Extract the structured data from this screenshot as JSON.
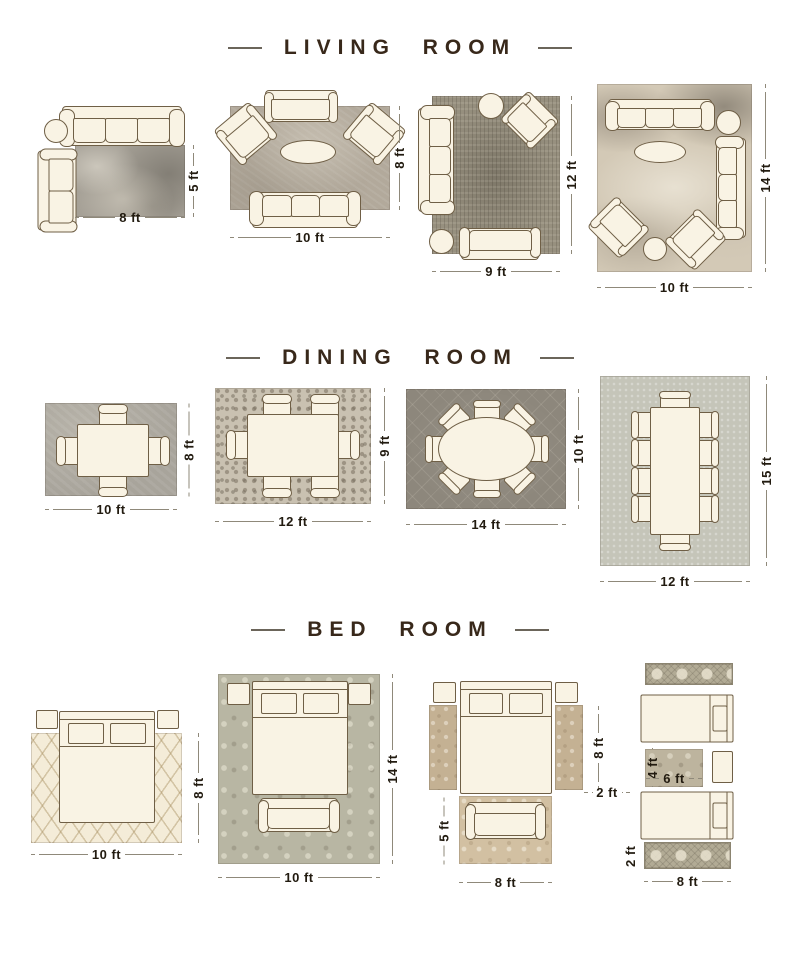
{
  "colors": {
    "background": "#ffffff",
    "title_text": "#38281a",
    "dimension_text": "#221b10",
    "dimension_line": "#8f897a",
    "furniture_fill": "#f9f3e4",
    "furniture_outline": "#6f5f46"
  },
  "sections": [
    {
      "title": "LIVING ROOM",
      "figures": [
        {
          "name": "living-8x5",
          "width_label": "8 ft",
          "height_label": "5 ft",
          "furniture": [
            "3-seat sofa",
            "round side table",
            "loveseat"
          ]
        },
        {
          "name": "living-10x8",
          "width_label": "10 ft",
          "height_label": "8 ft",
          "furniture": [
            "loveseat",
            "2 armchairs",
            "oval coffee table",
            "3-seat sofa"
          ]
        },
        {
          "name": "living-9x12",
          "width_label": "9 ft",
          "height_label": "12 ft",
          "furniture": [
            "3-seat sofa",
            "round side table",
            "armchair",
            "round side table",
            "loveseat"
          ]
        },
        {
          "name": "living-10x14",
          "width_label": "10 ft",
          "height_label": "14 ft",
          "furniture": [
            "3-seat sofa",
            "round side table",
            "oval coffee table",
            "3-seat sofa",
            "2 armchairs",
            "round side table"
          ]
        }
      ]
    },
    {
      "title": "DINING ROOM",
      "figures": [
        {
          "name": "dining-10x8",
          "width_label": "10 ft",
          "height_label": "8 ft",
          "furniture": [
            "dining table",
            "4 chairs"
          ]
        },
        {
          "name": "dining-12x9",
          "width_label": "12 ft",
          "height_label": "9 ft",
          "furniture": [
            "dining table",
            "6 chairs"
          ]
        },
        {
          "name": "dining-14x10",
          "width_label": "14 ft",
          "height_label": "10 ft",
          "furniture": [
            "oval dining table",
            "8 chairs"
          ]
        },
        {
          "name": "dining-12x15",
          "width_label": "12 ft",
          "height_label": "15 ft",
          "furniture": [
            "dining table",
            "10 chairs"
          ]
        }
      ]
    },
    {
      "title": "BED ROOM",
      "figures": [
        {
          "name": "bed-10x8",
          "width_label": "10 ft",
          "height_label": "8 ft",
          "furniture": [
            "queen bed",
            "2 nightstands"
          ]
        },
        {
          "name": "bed-10x14",
          "width_label": "10 ft",
          "height_label": "14 ft",
          "furniture": [
            "queen bed",
            "2 nightstands",
            "bench"
          ]
        },
        {
          "name": "bed-runners-8x5",
          "runner_height_label": "8 ft",
          "runner_width_label": "2 ft",
          "foot_rug_height_label": "5 ft",
          "foot_rug_width_label": "8 ft",
          "furniture": [
            "queen bed",
            "2 nightstands",
            "2 runner rugs",
            "bench",
            "accent rug"
          ]
        },
        {
          "name": "bed-twin-runners",
          "small_rug_height_label": "4 ft",
          "small_rug_width_label": "6 ft",
          "runner_height_label": "2 ft",
          "runner_width_label": "8 ft",
          "furniture": [
            "2 runner rugs",
            "2 twin beds",
            "accent rug",
            "nightstand"
          ]
        }
      ]
    }
  ]
}
